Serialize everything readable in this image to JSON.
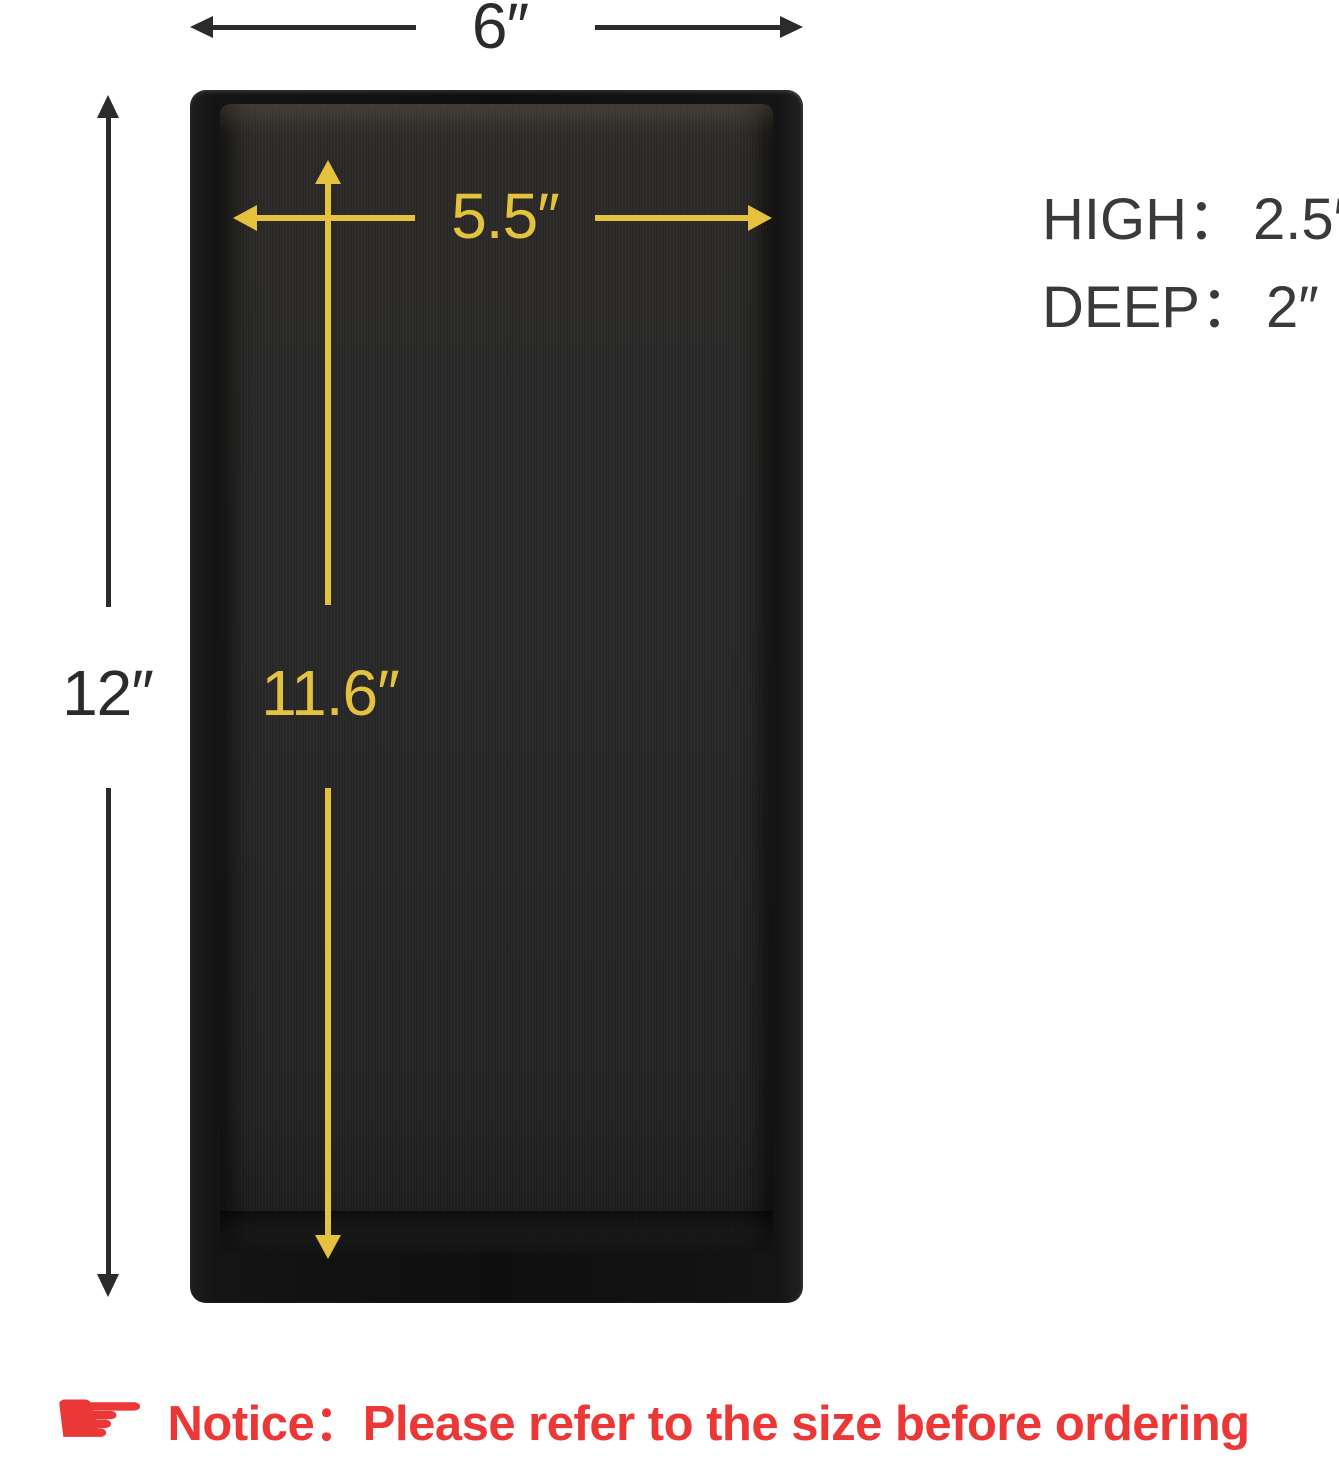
{
  "diagram": {
    "outer_width_label": "6″",
    "outer_height_label": "12″",
    "inner_width_label": "5.5″",
    "inner_height_label": "11.6″"
  },
  "specs": [
    {
      "label": "HIGH：",
      "value": "2.5″"
    },
    {
      "label": "DEEP：",
      "value": "2″"
    }
  ],
  "notice": {
    "icon": "☛",
    "text": "Notice：Please refer to the size before ordering"
  },
  "colors": {
    "dimension_yellow": "#e4c23e",
    "dimension_line_dark": "#2b2b2b",
    "spec_text": "#3a3a3a",
    "notice_red": "#ec3737",
    "tray_black": "#141414",
    "tray_floor": "#282828",
    "background": "#ffffff"
  }
}
